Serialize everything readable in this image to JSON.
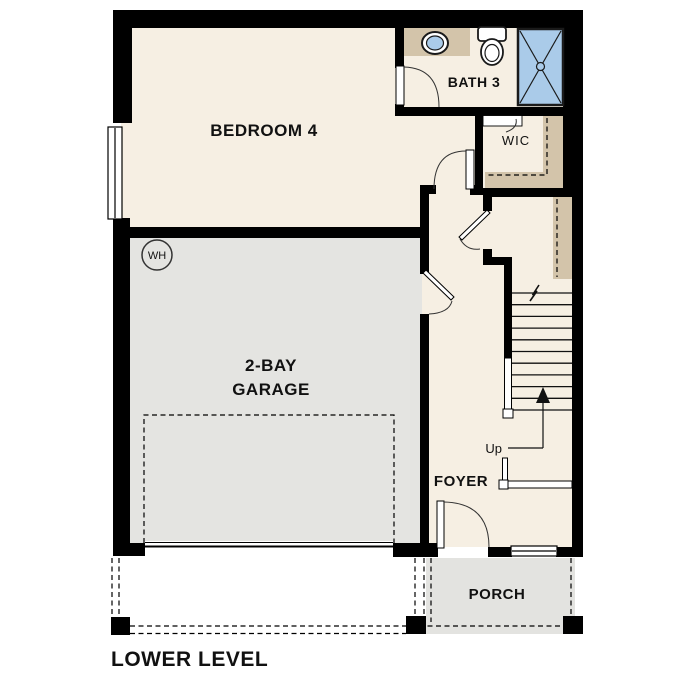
{
  "plan": {
    "title": "LOWER LEVEL",
    "rooms": {
      "bedroom4": {
        "label": "BEDROOM 4"
      },
      "bath3": {
        "label": "BATH 3"
      },
      "wic": {
        "label": "WIC"
      },
      "garage": {
        "label_line1": "2-BAY",
        "label_line2": "GARAGE"
      },
      "foyer": {
        "label": "FOYER"
      },
      "porch": {
        "label": "PORCH"
      }
    },
    "annotations": {
      "water_heater_label": "WH",
      "stair_direction_label": "Up"
    },
    "colors": {
      "floor": "#f6efe3",
      "garage_floor": "#e4e4e1",
      "porch_floor": "#e3e3e0",
      "casework_tan": "#d3c4aa",
      "shower_blue": "#aacbe9",
      "wall": "#000000",
      "text": "#111111"
    }
  }
}
